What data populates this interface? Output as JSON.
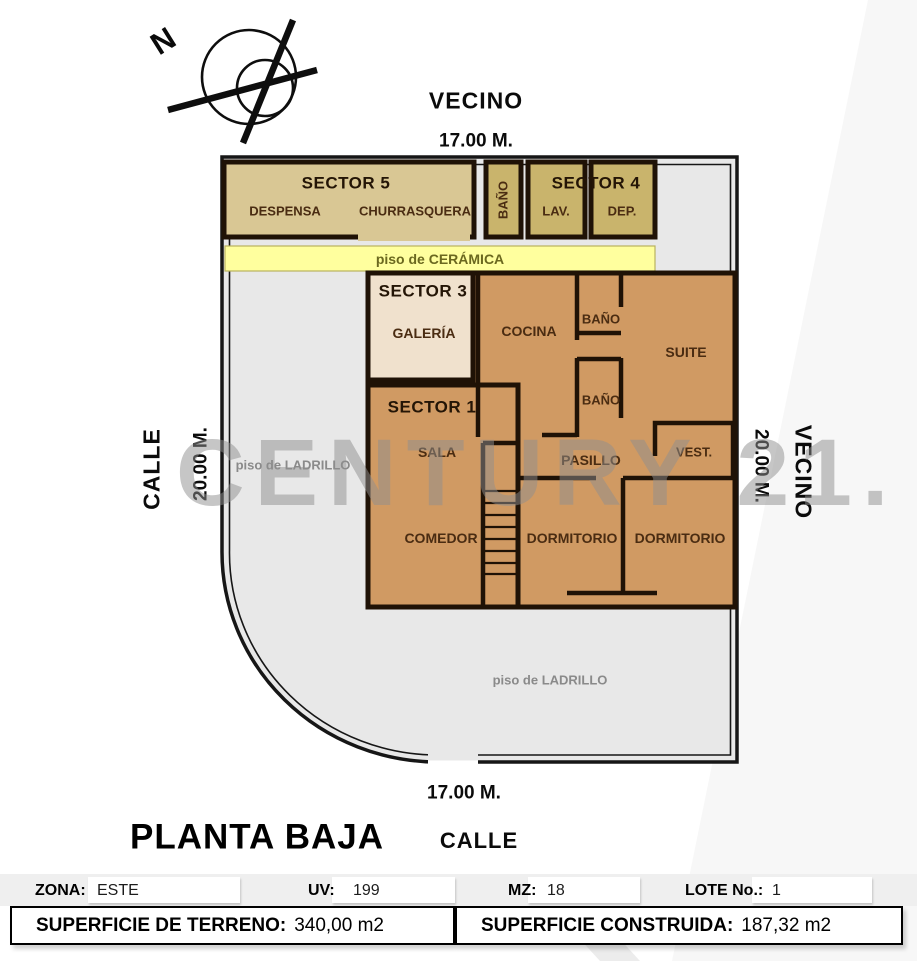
{
  "title": "PLANTA BAJA",
  "watermark": "CENTURY 21.",
  "compass": {
    "north": "N"
  },
  "boundaries": {
    "top_neighbor": "VECINO",
    "top_dim": "17.00 M.",
    "left_street": "CALLE",
    "left_dim": "20.00 M.",
    "right_dim": "20.00 M.",
    "right_neighbor": "VECINO",
    "bottom_dim": "17.00 M.",
    "bottom_street": "CALLE"
  },
  "floors": {
    "ceramica": "piso de CERÁMICA",
    "ladrillo_left": "piso de LADRILLO",
    "ladrillo_bottom": "piso de LADRILLO"
  },
  "sectors": {
    "sector5": {
      "title": "SECTOR 5",
      "room1": "DESPENSA",
      "room2": "CHURRASQUERA"
    },
    "bath_strip": "BAÑO",
    "sector4": {
      "title": "SECTOR 4",
      "room1": "LAV.",
      "room2": "DEP."
    },
    "sector3": {
      "title": "SECTOR 3",
      "room1": "GALERÍA"
    },
    "sector1": {
      "title": "SECTOR 1"
    }
  },
  "rooms": {
    "cocina": "COCINA",
    "bano1": "BAÑO",
    "suite": "SUITE",
    "bano2": "BAÑO",
    "sala": "SALA",
    "pasillo": "PASILLO",
    "vest": "VEST.",
    "comedor": "COMEDOR",
    "dormitorio1": "DORMITORIO",
    "dormitorio2": "DORMITORIO"
  },
  "info": {
    "zona_label": "ZONA:",
    "zona_value": "ESTE",
    "uv_label": "UV:",
    "uv_value": "199",
    "mz_label": "MZ:",
    "mz_value": "18",
    "lote_label": "LOTE No.:",
    "lote_value": "1",
    "terreno_label": "SUPERFICIE DE TERRENO:",
    "terreno_value": "340,00 m2",
    "construida_label": "SUPERFICIE CONSTRUIDA:",
    "construida_value": "187,32 m2"
  },
  "colors": {
    "wall": "#1f1206",
    "lot_gray": "#e8e8e8",
    "room_tan": "#d09a63",
    "galeria_cream": "#f0e1cd",
    "sector5_tan": "#d9c794",
    "khaki": "#c9b46c",
    "ceramic_yellow": "#ffff9e",
    "watermark_gray": "#8f8f8f"
  }
}
